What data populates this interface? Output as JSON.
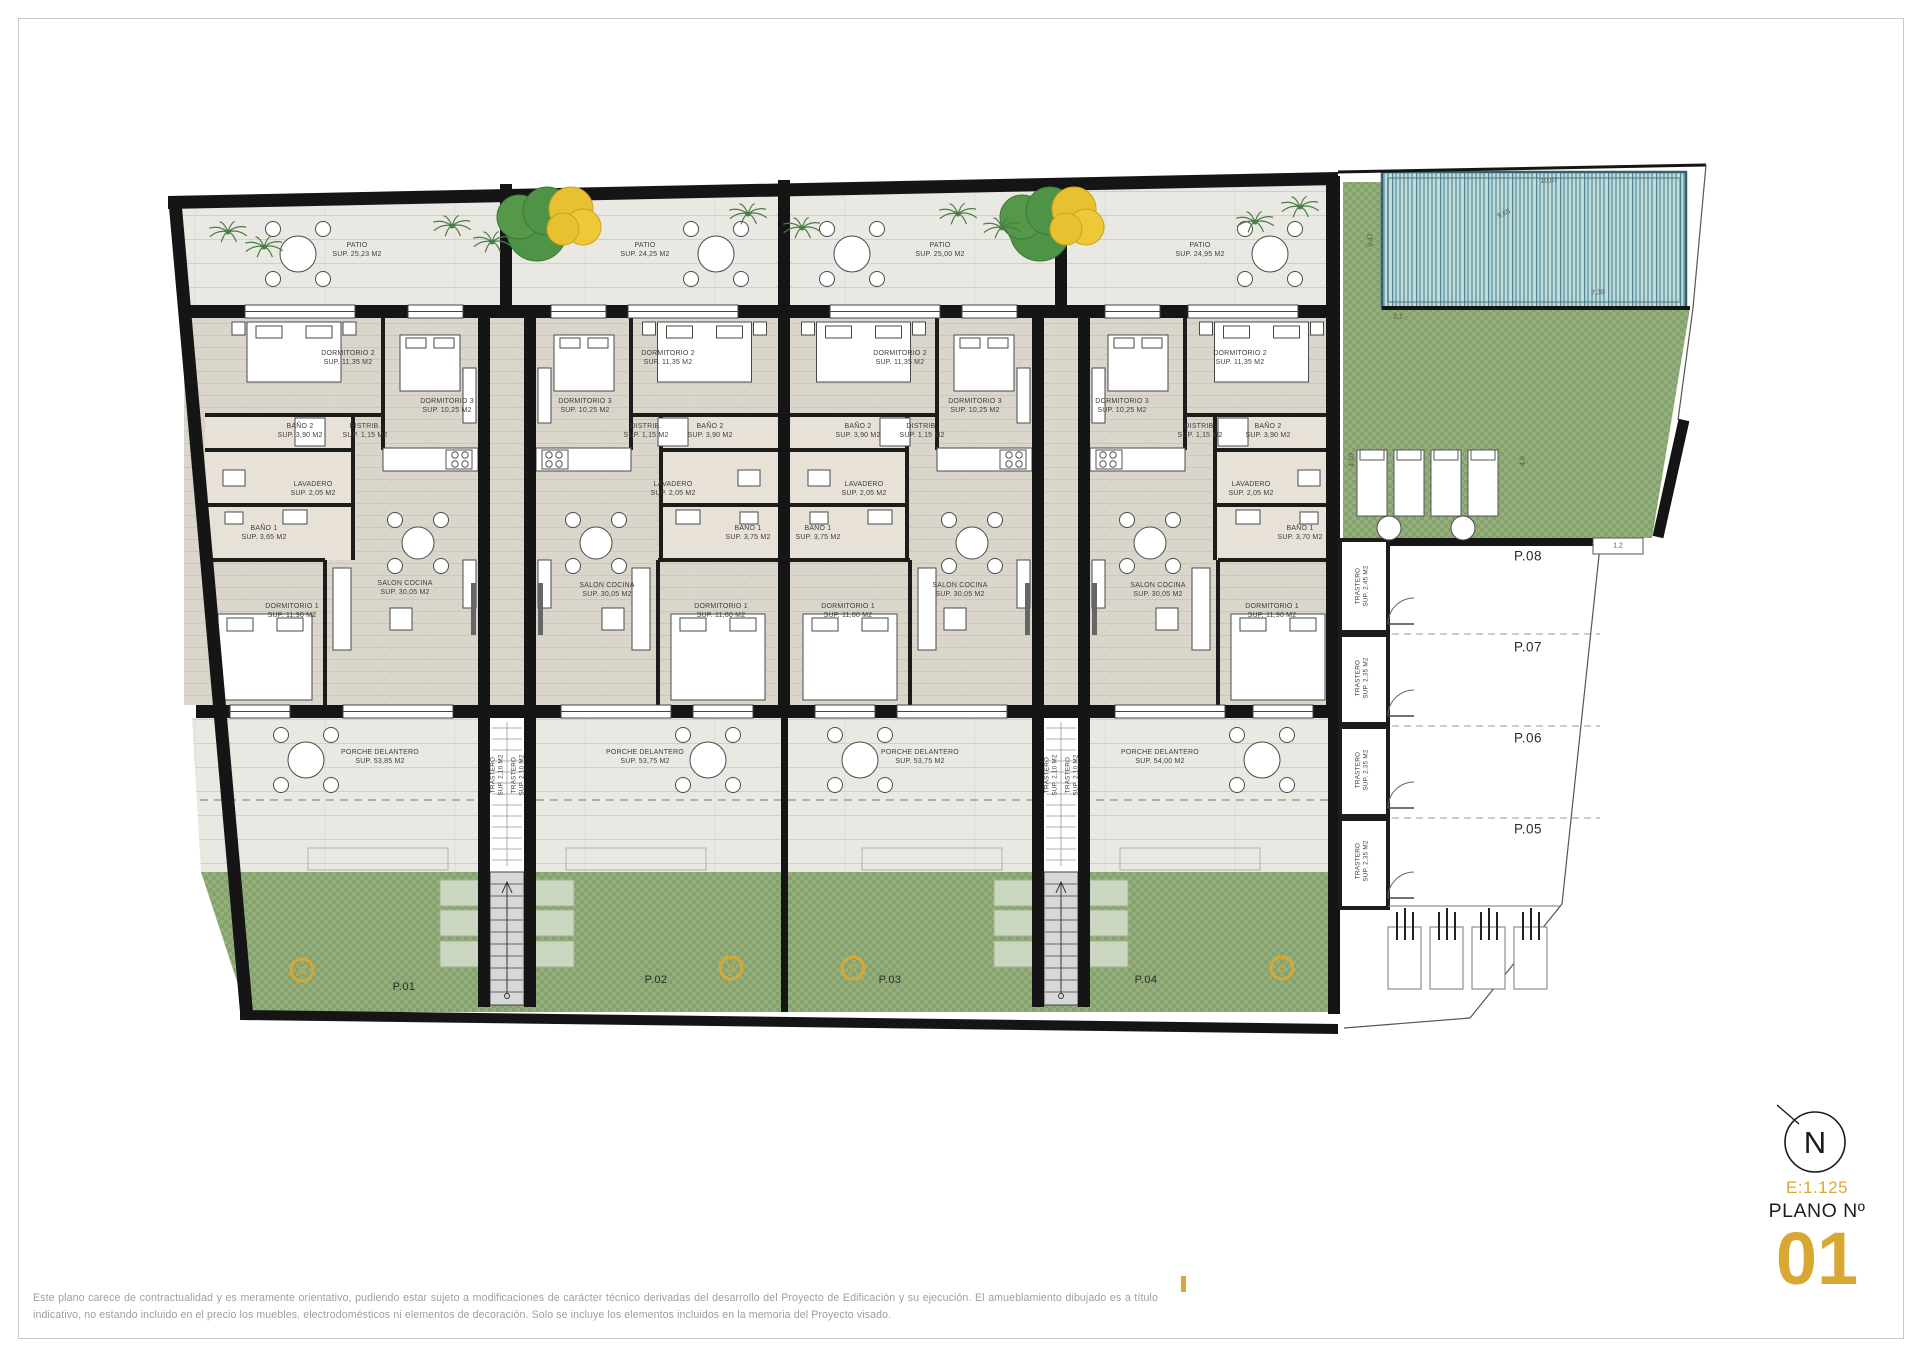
{
  "drawing": {
    "scale": "E:1.125",
    "sheet_label": "PLANO Nº",
    "sheet_number": "01",
    "north_letter": "N"
  },
  "footer": {
    "line1": "Este plano carece de contractualidad y es meramente orientativo, pudiendo estar sujeto a modificaciones de carácter técnico derivadas del desarrollo del Proyecto de Edificación y su ejecución. El amueblamiento dibujado es a título",
    "line2": "indicativo, no estando incluido en el precio los muebles, electrodomésticos ni elementos de decoración. Solo se incluye los elementos incluidos en la memoria del Proyecto visado."
  },
  "colors": {
    "accent": "#D9A733",
    "green": "#95ae7e",
    "pool": "#c3dadb",
    "wall": "#1c1c1c"
  },
  "labels": [
    {
      "t1": "PATIO",
      "t2": "SUP. 25,23 M2",
      "x": 357,
      "y": 250,
      "k": "room"
    },
    {
      "t1": "DORMITORIO 2",
      "t2": "SUP. 11,35 M2",
      "x": 348,
      "y": 358,
      "k": "room"
    },
    {
      "t1": "DORMITORIO 3",
      "t2": "SUP. 10,25 M2",
      "x": 447,
      "y": 406,
      "k": "room"
    },
    {
      "t1": "BAÑO 2",
      "t2": "SUP. 3,90 M2",
      "x": 300,
      "y": 431,
      "k": "room"
    },
    {
      "t1": "DISTRIB.",
      "t2": "SUP. 1,15 M2",
      "x": 365,
      "y": 431,
      "k": "room"
    },
    {
      "t1": "LAVADERO",
      "t2": "SUP. 2,05 M2",
      "x": 313,
      "y": 489,
      "k": "room"
    },
    {
      "t1": "BAÑO 1",
      "t2": "SUP. 3,65 M2",
      "x": 264,
      "y": 533,
      "k": "room"
    },
    {
      "t1": "SALON COCINA",
      "t2": "SUP. 30,05 M2",
      "x": 405,
      "y": 588,
      "k": "room"
    },
    {
      "t1": "DORMITORIO 1",
      "t2": "SUP. 11,90 M2",
      "x": 292,
      "y": 611,
      "k": "room"
    },
    {
      "t1": "PORCHE DELANTERO",
      "t2": "SUP. 53,85 M2",
      "x": 380,
      "y": 757,
      "k": "room"
    },
    {
      "t1": "PATIO",
      "t2": "SUP. 24,25 M2",
      "x": 645,
      "y": 250,
      "k": "room"
    },
    {
      "t1": "DORMITORIO 2",
      "t2": "SUP. 11,35 M2",
      "x": 668,
      "y": 358,
      "k": "room"
    },
    {
      "t1": "DORMITORIO 3",
      "t2": "SUP. 10,25 M2",
      "x": 585,
      "y": 406,
      "k": "room"
    },
    {
      "t1": "BAÑO 2",
      "t2": "SUP. 3,90 M2",
      "x": 710,
      "y": 431,
      "k": "room"
    },
    {
      "t1": "DISTRIB.",
      "t2": "SUP. 1,15 M2",
      "x": 646,
      "y": 431,
      "k": "room"
    },
    {
      "t1": "LAVADERO",
      "t2": "SUP. 2,05 M2",
      "x": 673,
      "y": 489,
      "k": "room"
    },
    {
      "t1": "BAÑO 1",
      "t2": "SUP. 3,75 M2",
      "x": 748,
      "y": 533,
      "k": "room"
    },
    {
      "t1": "SALON COCINA",
      "t2": "SUP. 30,05 M2",
      "x": 607,
      "y": 590,
      "k": "room"
    },
    {
      "t1": "DORMITORIO 1",
      "t2": "SUP. 11,80 M2",
      "x": 721,
      "y": 611,
      "k": "room"
    },
    {
      "t1": "PORCHE DELANTERO",
      "t2": "SUP. 53,75 M2",
      "x": 645,
      "y": 757,
      "k": "room"
    },
    {
      "t1": "PATIO",
      "t2": "SUP. 25,00 M2",
      "x": 940,
      "y": 250,
      "k": "room"
    },
    {
      "t1": "DORMITORIO 2",
      "t2": "SUP. 11,35 M2",
      "x": 900,
      "y": 358,
      "k": "room"
    },
    {
      "t1": "DORMITORIO 3",
      "t2": "SUP. 10,25 M2",
      "x": 975,
      "y": 406,
      "k": "room"
    },
    {
      "t1": "BAÑO 2",
      "t2": "SUP. 3,90 M2",
      "x": 858,
      "y": 431,
      "k": "room"
    },
    {
      "t1": "DISTRIB.",
      "t2": "SUP. 1,15 M2",
      "x": 922,
      "y": 431,
      "k": "room"
    },
    {
      "t1": "LAVADERO",
      "t2": "SUP. 2,05 M2",
      "x": 864,
      "y": 489,
      "k": "room"
    },
    {
      "t1": "BAÑO 1",
      "t2": "SUP. 3,75 M2",
      "x": 818,
      "y": 533,
      "k": "room"
    },
    {
      "t1": "SALON COCINA",
      "t2": "SUP. 30,05 M2",
      "x": 960,
      "y": 590,
      "k": "room"
    },
    {
      "t1": "DORMITORIO 1",
      "t2": "SUP. 11,80 M2",
      "x": 848,
      "y": 611,
      "k": "room"
    },
    {
      "t1": "PORCHE DELANTERO",
      "t2": "SUP. 53,75 M2",
      "x": 920,
      "y": 757,
      "k": "room"
    },
    {
      "t1": "PATIO",
      "t2": "SUP. 24,95 M2",
      "x": 1200,
      "y": 250,
      "k": "room"
    },
    {
      "t1": "DORMITORIO 2",
      "t2": "SUP. 11,35 M2",
      "x": 1240,
      "y": 358,
      "k": "room"
    },
    {
      "t1": "DORMITORIO 3",
      "t2": "SUP. 10,25 M2",
      "x": 1122,
      "y": 406,
      "k": "room"
    },
    {
      "t1": "BAÑO 2",
      "t2": "SUP. 3,90 M2",
      "x": 1268,
      "y": 431,
      "k": "room"
    },
    {
      "t1": "DISTRIB.",
      "t2": "SUP. 1,15 M2",
      "x": 1200,
      "y": 431,
      "k": "room"
    },
    {
      "t1": "LAVADERO",
      "t2": "SUP. 2,05 M2",
      "x": 1251,
      "y": 489,
      "k": "room"
    },
    {
      "t1": "BAÑO 1",
      "t2": "SUP. 3,70 M2",
      "x": 1300,
      "y": 533,
      "k": "room"
    },
    {
      "t1": "SALON COCINA",
      "t2": "SUP. 30,05 M2",
      "x": 1158,
      "y": 590,
      "k": "room"
    },
    {
      "t1": "DORMITORIO 1",
      "t2": "SUP. 11,90 M2",
      "x": 1272,
      "y": 611,
      "k": "room"
    },
    {
      "t1": "PORCHE DELANTERO",
      "t2": "SUP. 54,00 M2",
      "x": 1160,
      "y": 757,
      "k": "room"
    },
    {
      "t1": "TRASTERO",
      "t2": "SUP. 2,10 M2",
      "x": 497,
      "y": 775,
      "k": "tr",
      "r": -90
    },
    {
      "t1": "TRASTERO",
      "t2": "SUP. 2,10 M2",
      "x": 518,
      "y": 775,
      "k": "tr",
      "r": -90
    },
    {
      "t1": "TRASTERO",
      "t2": "SUP. 2,10 M2",
      "x": 1051,
      "y": 775,
      "k": "tr",
      "r": -90
    },
    {
      "t1": "TRASTERO",
      "t2": "SUP. 2,10 M2",
      "x": 1072,
      "y": 775,
      "k": "tr",
      "r": -90
    },
    {
      "t1": "TRASTERO",
      "t2": "SUP. 2,45 M2",
      "x": 1362,
      "y": 586,
      "k": "tr",
      "r": -90
    },
    {
      "t1": "TRASTERO",
      "t2": "SUP. 2,35 M2",
      "x": 1362,
      "y": 678,
      "k": "tr",
      "r": -90
    },
    {
      "t1": "TRASTERO",
      "t2": "SUP. 2,35 M2",
      "x": 1362,
      "y": 770,
      "k": "tr",
      "r": -90
    },
    {
      "t1": "TRASTERO",
      "t2": "SUP. 2,35 M2",
      "x": 1362,
      "y": 861,
      "k": "tr",
      "r": -90
    },
    {
      "t1": "P.01",
      "x": 404,
      "y": 987,
      "k": "unit"
    },
    {
      "t1": "P.02",
      "x": 656,
      "y": 980,
      "k": "unit"
    },
    {
      "t1": "P.03",
      "x": 890,
      "y": 980,
      "k": "unit"
    },
    {
      "t1": "P.04",
      "x": 1146,
      "y": 980,
      "k": "unit"
    },
    {
      "t1": "P.08",
      "x": 1528,
      "y": 556,
      "k": "park"
    },
    {
      "t1": "P.07",
      "x": 1528,
      "y": 647,
      "k": "park"
    },
    {
      "t1": "P.06",
      "x": 1528,
      "y": 738,
      "k": "park"
    },
    {
      "t1": "P.05",
      "x": 1528,
      "y": 829,
      "k": "park"
    },
    {
      "t1": "10,07",
      "x": 1549,
      "y": 181,
      "k": "dim",
      "r": -3
    },
    {
      "t1": "9,65",
      "x": 1504,
      "y": 214,
      "k": "dim",
      "r": -25
    },
    {
      "t1": "7,39",
      "x": 1598,
      "y": 293,
      "k": "dim",
      "r": -3
    },
    {
      "t1": "9,47",
      "x": 1371,
      "y": 240,
      "k": "dim",
      "r": -90
    },
    {
      "t1": "2,1",
      "x": 1398,
      "y": 317,
      "k": "dim"
    },
    {
      "t1": "4,10",
      "x": 1352,
      "y": 460,
      "k": "dim",
      "r": -90
    },
    {
      "t1": "4,6",
      "x": 1523,
      "y": 461,
      "k": "dim",
      "r": -90
    },
    {
      "t1": "1,2",
      "x": 1618,
      "y": 546,
      "k": "dim"
    }
  ]
}
